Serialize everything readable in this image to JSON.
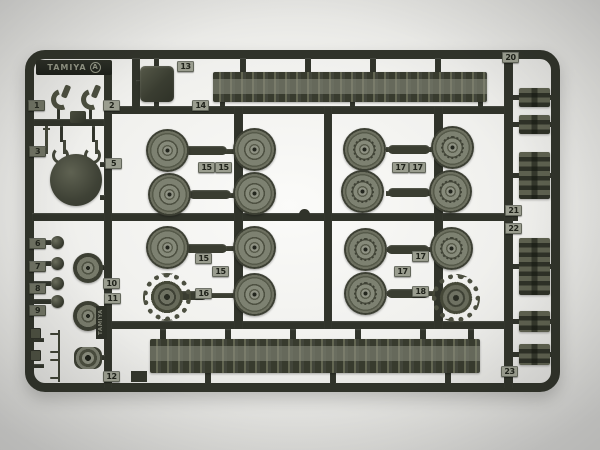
{
  "brand": {
    "name": "TAMIYA",
    "sprue_letter": "A",
    "side_text": "TAMIYA"
  },
  "colors": {
    "sprue": "#30332a",
    "part": "#787b6b",
    "part_dark": "#3a3d31",
    "part_light": "#8e9181",
    "tag_bg": "#9a9d8f",
    "tag_text": "#20231b",
    "background": "#d8d8d5"
  },
  "tags": {
    "t1": "1",
    "t2": "2",
    "t3": "3",
    "t5": "5",
    "t6": "6",
    "t7": "7",
    "t8": "8",
    "t9": "9",
    "t10": "10",
    "t11": "11",
    "t12": "12",
    "t13": "13",
    "t14": "14",
    "q1_15a": "15",
    "q1_15b": "15",
    "q2_17a": "17",
    "q2_17b": "17",
    "q3_15a": "15",
    "q3_15b": "15",
    "t16": "16",
    "q4_17a": "17",
    "q4_17b": "17",
    "t18": "18",
    "t20": "20",
    "t21": "21",
    "t22": "22",
    "t23": "23"
  }
}
